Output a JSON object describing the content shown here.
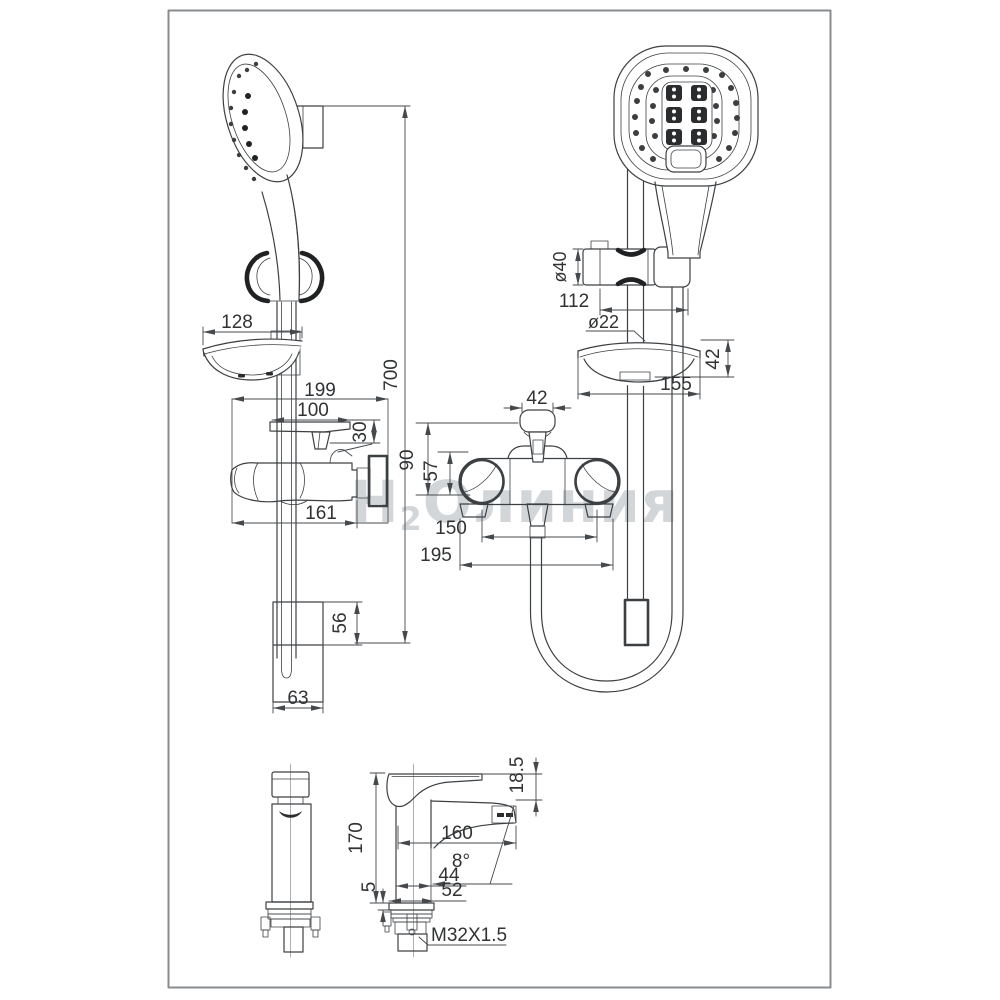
{
  "watermark": {
    "h": "Н",
    "sub": "2",
    "rest": "Олиния"
  },
  "views": {
    "shower_set_side": {
      "rail_length": "700",
      "soap_dish_width": "128",
      "mixer_box_width": "199",
      "handle_length": "100",
      "handle_height": "30",
      "body_width": "161",
      "bracket_height": "56",
      "bracket_width": "63"
    },
    "shower_set_front": {
      "holder_diameter": "ø40",
      "holder_width": "112",
      "bar_diameter": "ø22",
      "soap_dish_height": "42",
      "soap_dish_width": "155",
      "handle_width": "42",
      "mixer_height": "90",
      "body_height": "57",
      "inlet_spacing": "150",
      "overall_width": "195"
    },
    "basin_mixer": {
      "height": "170",
      "spout_drop": "18.5",
      "spout_reach": "160",
      "spout_angle": "8°",
      "body_width": "44",
      "base_width": "52",
      "base_plate_thickness": "5",
      "thread": "M32X1.5"
    }
  }
}
